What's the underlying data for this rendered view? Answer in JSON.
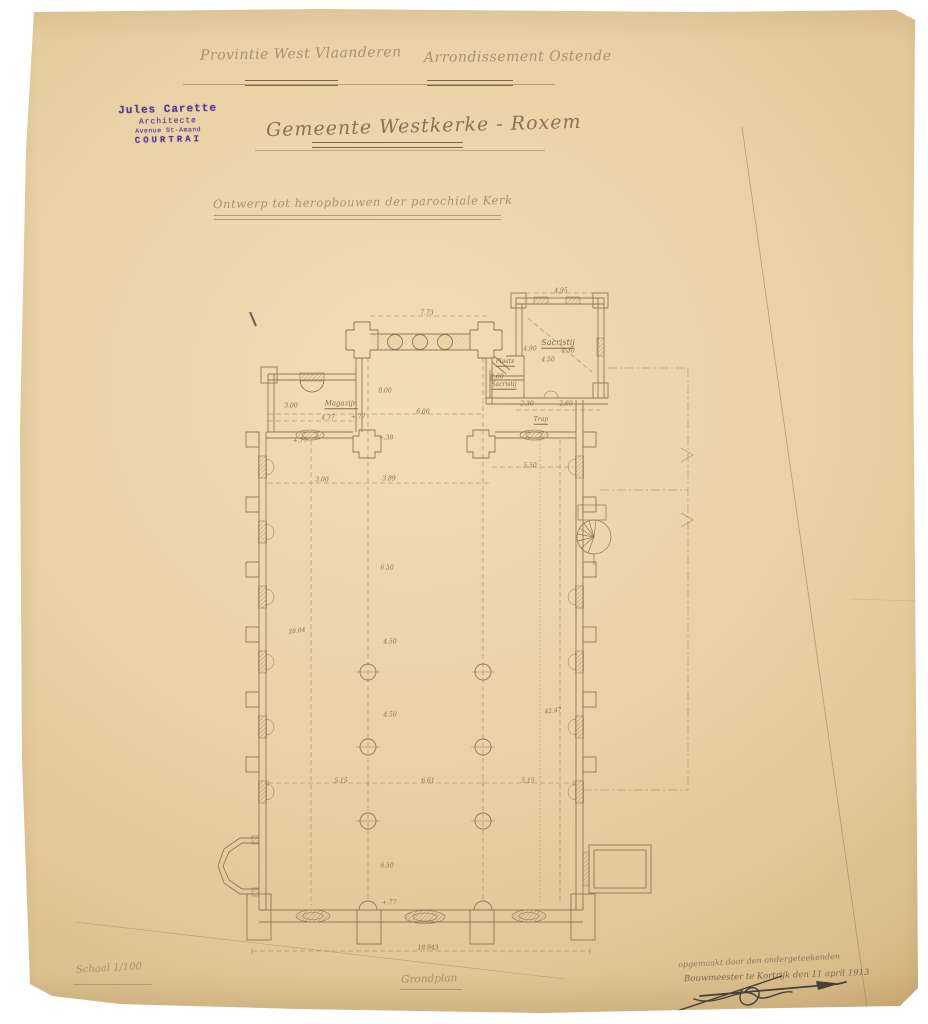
{
  "page": {
    "background_color": "#ffffff",
    "paper_color": "#e9d2a5",
    "ink_color": "#8a6f52",
    "pencil_color": "#9c8465",
    "stamp_color": "#53389b"
  },
  "header": {
    "province": "Provintie West Vlaanderen",
    "district": "Arrondissement Ostende"
  },
  "stamp": {
    "name": "Jules Carette",
    "role": "Architecte",
    "address": "Avenue St-Amand",
    "city": "COURTRAI"
  },
  "title": {
    "main": "Gemeente Westkerke - Roxem",
    "subtitle": "Ontwerp tot heropbouwen der parochiale Kerk"
  },
  "footer": {
    "scale": "Schaal 1/100",
    "plan_label": "Grondplan",
    "attestation_line1": "opgemaakt door den ondergeteekenden",
    "attestation_line2": "Bouwmeester te Kortrijk den 11 april 1913"
  },
  "plan": {
    "room_labels": [
      {
        "t": "Sacristij",
        "x": 558,
        "y": 343,
        "fs": 8
      },
      {
        "t": "Plaats",
        "x": 505,
        "y": 362,
        "fs": 6
      },
      {
        "t": "Sacristij",
        "x": 504,
        "y": 385,
        "fs": 6
      },
      {
        "t": "Magazijn",
        "x": 341,
        "y": 404,
        "fs": 7
      },
      {
        "t": "Trap",
        "x": 541,
        "y": 420,
        "fs": 6
      }
    ],
    "dimensions": [
      {
        "t": "7.73",
        "x": 427,
        "y": 313
      },
      {
        "t": "4.95",
        "x": 561,
        "y": 291
      },
      {
        "t": "4.90",
        "x": 530,
        "y": 349
      },
      {
        "t": "4.30",
        "x": 568,
        "y": 351
      },
      {
        "t": "4.50",
        "x": 548,
        "y": 360
      },
      {
        "t": "2.60",
        "x": 497,
        "y": 377
      },
      {
        "t": "8.00",
        "x": 385,
        "y": 391
      },
      {
        "t": "6.00",
        "x": 423,
        "y": 412
      },
      {
        "t": "3.00",
        "x": 291,
        "y": 406
      },
      {
        "t": "4.77",
        "x": 328,
        "y": 418
      },
      {
        "t": "+.77",
        "x": 358,
        "y": 417
      },
      {
        "t": "2.30",
        "x": 527,
        "y": 404
      },
      {
        "t": "2.60",
        "x": 566,
        "y": 404
      },
      {
        "t": "+.77",
        "x": 300,
        "y": 441
      },
      {
        "t": "+.38",
        "x": 386,
        "y": 438
      },
      {
        "t": "3.00",
        "x": 322,
        "y": 480
      },
      {
        "t": "3.89",
        "x": 389,
        "y": 479
      },
      {
        "t": "5.50",
        "x": 530,
        "y": 466
      },
      {
        "t": "6.50",
        "x": 387,
        "y": 568
      },
      {
        "t": "28.04",
        "x": 297,
        "y": 631,
        "r": -8
      },
      {
        "t": "4.50",
        "x": 390,
        "y": 642
      },
      {
        "t": "4.50",
        "x": 390,
        "y": 715
      },
      {
        "t": "42.47",
        "x": 553,
        "y": 711,
        "r": -8
      },
      {
        "t": "5.15",
        "x": 341,
        "y": 781
      },
      {
        "t": "6.61",
        "x": 428,
        "y": 781
      },
      {
        "t": "5.15",
        "x": 528,
        "y": 781
      },
      {
        "t": "6.50",
        "x": 387,
        "y": 866
      },
      {
        "t": "+.77",
        "x": 389,
        "y": 903
      },
      {
        "t": "18.943",
        "x": 428,
        "y": 948
      }
    ]
  }
}
